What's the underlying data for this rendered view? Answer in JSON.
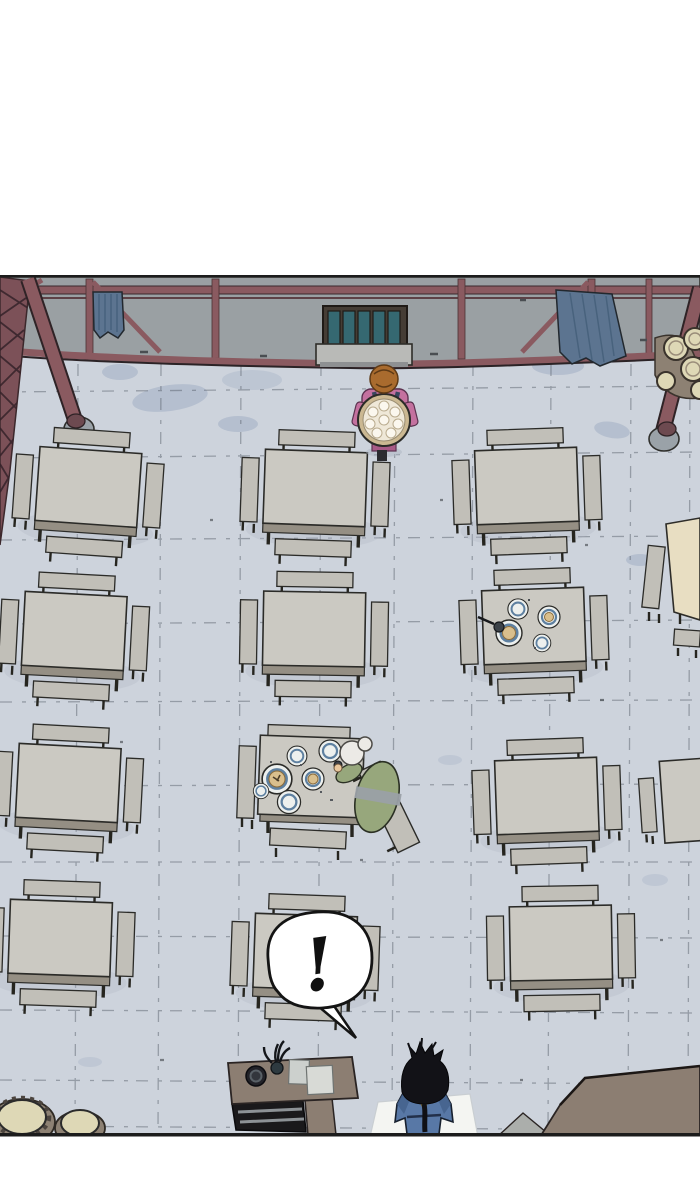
{
  "speech_bubble": {
    "text": "!"
  },
  "scene": {
    "description": "overhead-dining-hall-comic-panel",
    "characters": [
      "server-carrying-tray",
      "old-man-eating-at-table",
      "black-haired-protagonist"
    ],
    "props": [
      "dining-tables",
      "benches",
      "service-counter",
      "storage-jars",
      "windows",
      "support-columns"
    ]
  },
  "colors": {
    "pageBg": "#ffffff",
    "outline": "#2e2d29",
    "floor": "#cdd3dc",
    "floorLine": "#525a64",
    "wall": "#9aa0a3",
    "beam": "#8a5a60",
    "beamDark": "#4f3337",
    "lattice": "#7c5158",
    "table": "#cbc9c2",
    "tableEdge": "#958f84",
    "bench": "#c1bfb8",
    "tanTable": "#e8dec2",
    "counter": "#8c7e72",
    "counterDark": "#1a191b",
    "windowFrame": "#453d35",
    "windowPane": "#356871",
    "slat": "#e9e9cd",
    "curtain": "#5c7490",
    "sill": "#b9bab7",
    "jarTop": "#ded8b6",
    "jarBody": "#8d8173",
    "stain": "#b3bdcd",
    "bubbleFill": "#ffffff",
    "bubbleStroke": "#141414",
    "plateRing": "#5e80a0",
    "plateFill": "#edf0ee",
    "food": "#d9bf8d",
    "womanHair": "#a96b2e",
    "womanDress": "#c4719f",
    "womanDressDark": "#a85a86",
    "strap": "#39465f",
    "skin": "#e9c79d",
    "oldManRobe": "#97a77c",
    "oldManSash": "#9aa0a6",
    "hairWhite": "#eceae6",
    "blueRobe": "#5878a6",
    "blueRobeDark": "#44618c",
    "collar": "#d8c178",
    "hairBlack": "#121217",
    "whiteTable": "#f4f5f2",
    "grayWedge": "#abaeab",
    "colBase": "#9aa2a8"
  }
}
